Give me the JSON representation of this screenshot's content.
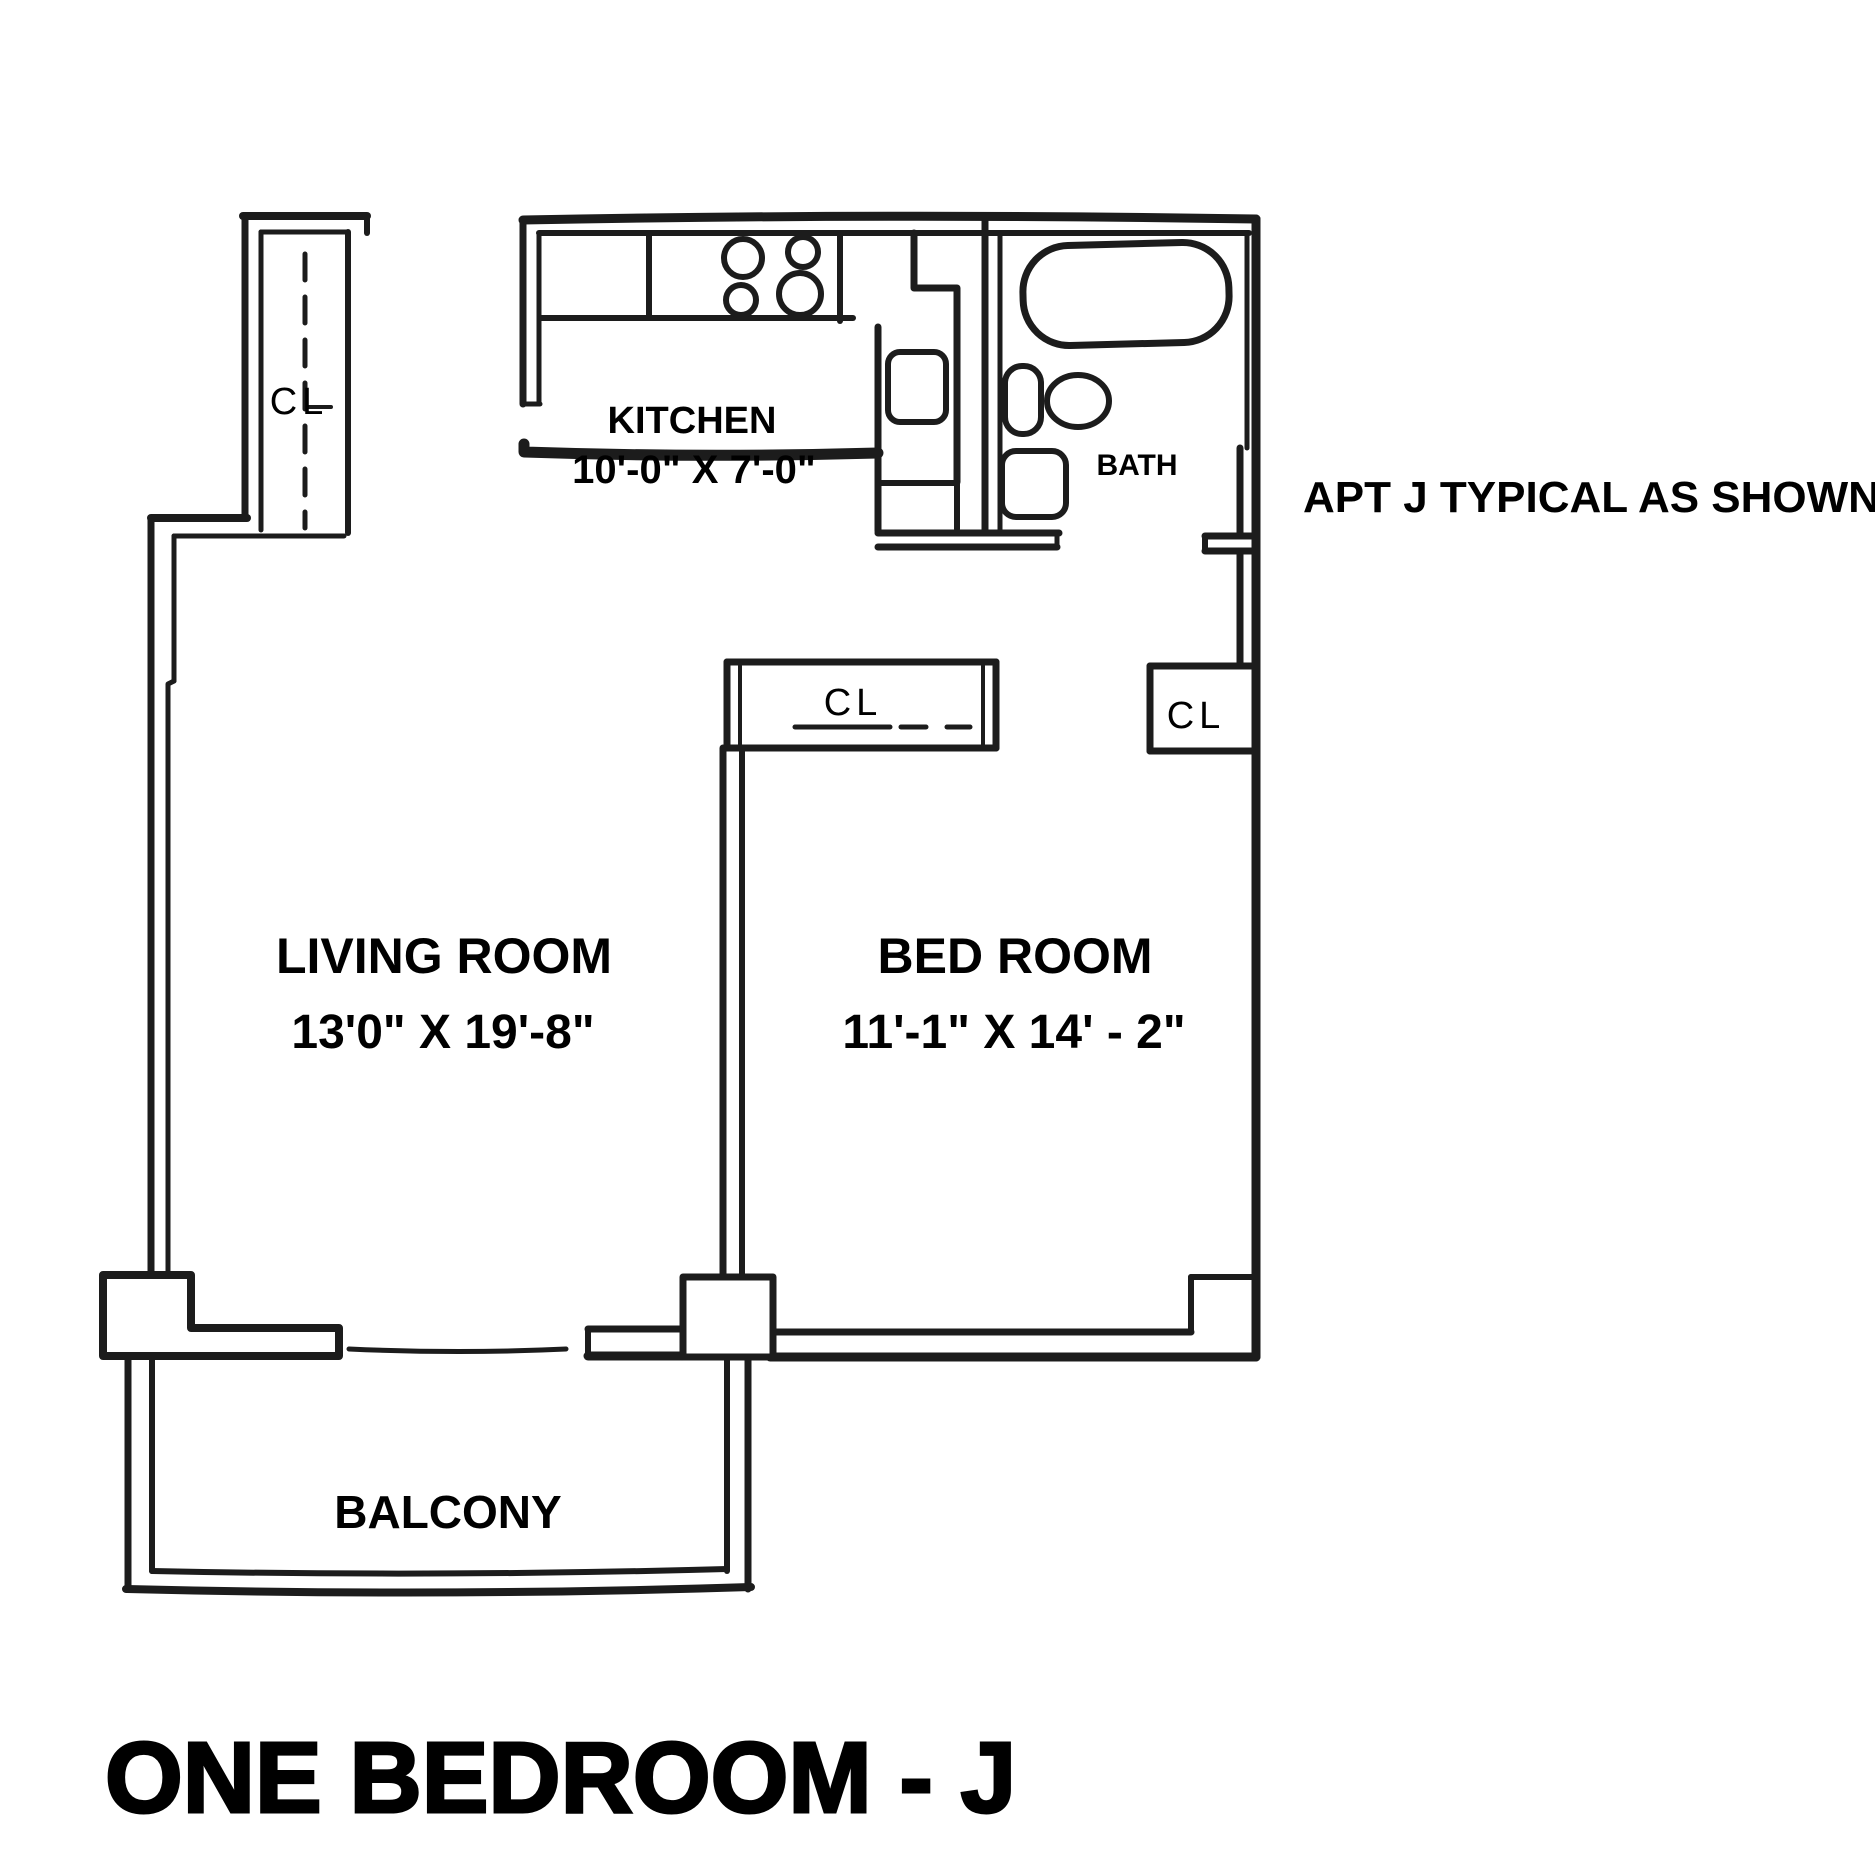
{
  "plan": {
    "title": "ONE BEDROOM - J",
    "note": "APT J TYPICAL AS SHOWN",
    "closet_label": "CL",
    "rooms": {
      "kitchen": {
        "name": "KITCHEN",
        "dims": "10'-0\" X 7'-0\""
      },
      "bath": {
        "name": "BATH"
      },
      "living": {
        "name": "LIVING ROOM",
        "dims": "13'0\" X 19'-8\""
      },
      "bedroom": {
        "name": "BED ROOM",
        "dims": "11'-1\" X 14' - 2\""
      },
      "balcony": {
        "name": "BALCONY"
      }
    },
    "fixtures": {
      "stove_burners": 4,
      "bath_items": [
        "bathtub",
        "sink",
        "toilet",
        "vanity-cabinet"
      ],
      "kitchen_items": [
        "counter",
        "stove",
        "refrigerator"
      ]
    },
    "colors": {
      "line": "#1c1c1c",
      "text": "#000000",
      "background": "#ffffff"
    }
  }
}
